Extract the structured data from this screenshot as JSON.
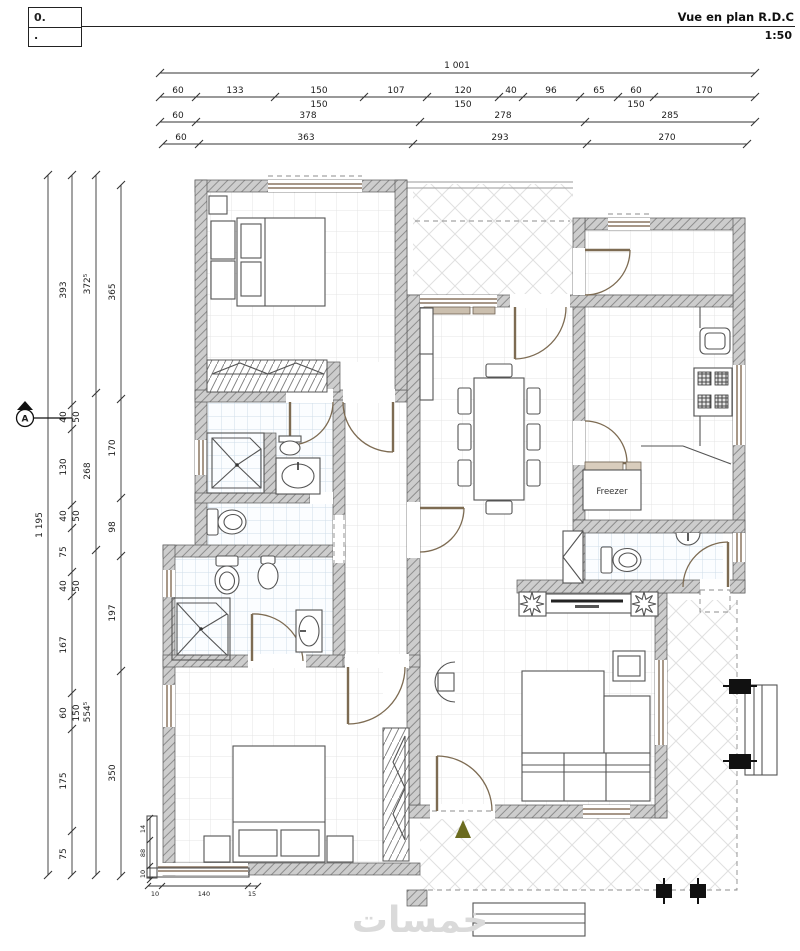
{
  "titlebar": {
    "ref_line1": "0.",
    "ref_line2": ".",
    "title": "Vue en plan R.D.C",
    "scale": "1:50"
  },
  "plan": {
    "freezer_label": "Freezer",
    "section_marker_label": "A",
    "watermark": "خمسات"
  },
  "dims": {
    "top_total": "1 001",
    "top_row2": [
      "60",
      "133",
      "150",
      "107",
      "120",
      "40",
      "96",
      "65",
      "60",
      "170"
    ],
    "top_row2_subs": [
      "150",
      "150",
      "150"
    ],
    "top_row3": [
      "60",
      "378",
      "278",
      "285"
    ],
    "top_row4": [
      "60",
      "363",
      "293",
      "270"
    ],
    "left_total": "1 195",
    "left_col2": [
      "393",
      "40",
      "130",
      "40",
      "75",
      "40",
      "167",
      "60",
      "175",
      "75"
    ],
    "left_col2_subs": [
      "50",
      "50",
      "50",
      "150"
    ],
    "left_col3": [
      "372⁵",
      "268",
      "554⁵"
    ],
    "left_col4": [
      "365",
      "170",
      "98",
      "197",
      "350"
    ],
    "corner_v": [
      "14",
      "88",
      "10"
    ],
    "corner_h": [
      "10",
      "140",
      "15"
    ]
  }
}
